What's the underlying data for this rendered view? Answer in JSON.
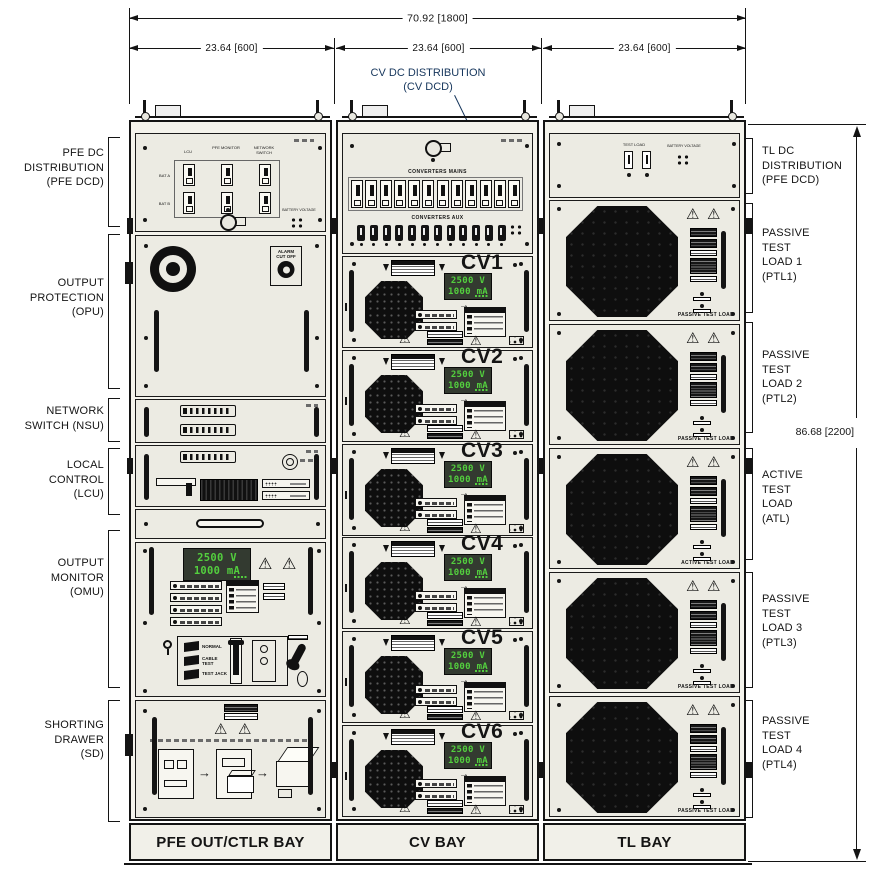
{
  "dimensions": {
    "overall_width": "70.92 [1800]",
    "bay1_width": "23.64 [600]",
    "bay2_width": "23.64 [600]",
    "bay3_width": "23.64 [600]",
    "overall_height": "86.68 [2200]"
  },
  "callout": {
    "line1": "CV DC DISTRIBUTION",
    "line2": "(CV DCD)"
  },
  "left_labels": [
    {
      "lines": [
        "PFE DC",
        "DISTRIBUTION",
        "(PFE DCD)"
      ]
    },
    {
      "lines": [
        "OUTPUT",
        "PROTECTION",
        "(OPU)"
      ]
    },
    {
      "lines": [
        "NETWORK",
        "SWITCH (NSU)"
      ]
    },
    {
      "lines": [
        "LOCAL",
        "CONTROL",
        "(LCU)"
      ]
    },
    {
      "lines": [
        "OUTPUT",
        "MONITOR",
        "(OMU)"
      ]
    },
    {
      "lines": [
        "SHORTING",
        "DRAWER",
        "(SD)"
      ]
    }
  ],
  "right_labels": [
    {
      "lines": [
        "TL DC",
        "DISTRIBUTION",
        "(PFE DCD)"
      ]
    },
    {
      "lines": [
        "PASSIVE",
        "TEST",
        "LOAD 1",
        "(PTL1)"
      ]
    },
    {
      "lines": [
        "PASSIVE",
        "TEST",
        "LOAD 2",
        "(PTL2)"
      ]
    },
    {
      "lines": [
        "ACTIVE",
        "TEST",
        "LOAD",
        "(ATL)"
      ]
    },
    {
      "lines": [
        "PASSIVE",
        "TEST",
        "LOAD 3",
        "(PTL3)"
      ]
    },
    {
      "lines": [
        "PASSIVE",
        "TEST",
        "LOAD 4",
        "(PTL4)"
      ]
    }
  ],
  "bay_names": [
    "PFE OUT/CTLR BAY",
    "CV BAY",
    "TL BAY"
  ],
  "pfe_dcd": {
    "columns": [
      "LCU",
      "PFE MONITOR",
      "NETWORK SWITCH"
    ],
    "rows": [
      "BAT A",
      "BAT B"
    ],
    "aux_label": "BATTERY VOLTAGE"
  },
  "opu": {
    "alarm_label_1": "ALARM",
    "alarm_label_2": "CUT OFF"
  },
  "omu": {
    "display_line1": "2500 V",
    "display_line2": "1000 mA",
    "positions": [
      "NORMAL",
      "CABLE TEST",
      "TEST JACK"
    ]
  },
  "cv_dcd": {
    "mains_label": "CONVERTERS MAINS",
    "aux_label": "CONVERTERS AUX"
  },
  "cv_modules": [
    {
      "label": "CV1",
      "display_line1": "2500 V",
      "display_line2": "1000 mA"
    },
    {
      "label": "CV2",
      "display_line1": "2500 V",
      "display_line2": "1000 mA"
    },
    {
      "label": "CV3",
      "display_line1": "2500 V",
      "display_line2": "1000 mA"
    },
    {
      "label": "CV4",
      "display_line1": "2500 V",
      "display_line2": "1000 mA"
    },
    {
      "label": "CV5",
      "display_line1": "2500 V",
      "display_line2": "1000 mA"
    },
    {
      "label": "CV6",
      "display_line1": "2500 V",
      "display_line2": "1000 mA"
    }
  ],
  "tl_dcd": {
    "load_label": "TEST LOAD",
    "battery_label": "BATTERY VOLTAGE"
  },
  "tl_modules": [
    {
      "caption": "PASSIVE TEST LOAD"
    },
    {
      "caption": "PASSIVE TEST LOAD"
    },
    {
      "caption": "ACTIVE TEST LOAD"
    },
    {
      "caption": "PASSIVE TEST LOAD"
    },
    {
      "caption": "PASSIVE TEST LOAD"
    }
  ],
  "icons": {
    "warning": "⚠",
    "arrow_right": "→"
  }
}
